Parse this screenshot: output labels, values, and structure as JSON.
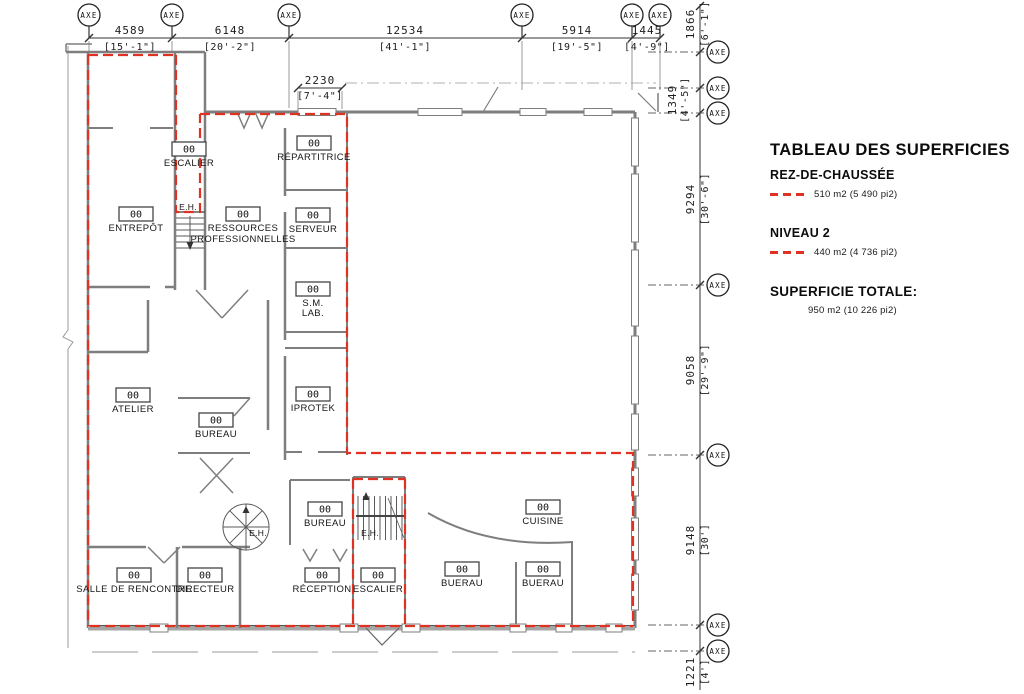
{
  "colors": {
    "overlay_red": "#DF3222",
    "wall_gray": "#8a8a8a",
    "line_dark": "#3c3c3c"
  },
  "axis_bubble_label": "AXE",
  "stair_exit_label": "E.H.",
  "dimensions": {
    "top": [
      {
        "mm": "4589",
        "imperial": "[15'-1\"]"
      },
      {
        "mm": "6148",
        "imperial": "[20'-2\"]"
      },
      {
        "mm": "12534",
        "imperial": "[41'-1\"]"
      },
      {
        "mm": "5914",
        "imperial": "[19'-5\"]"
      },
      {
        "mm": "1445",
        "imperial": "[4'-9\"]"
      }
    ],
    "top_right_vertical": {
      "mm": "1866",
      "imperial": "[6'-1\"]"
    },
    "interior": {
      "mm": "2230",
      "imperial": "[7'-4\"]"
    },
    "right": [
      {
        "mm": "1349",
        "imperial": "[4'-5\"]"
      },
      {
        "mm": "9294",
        "imperial": "[30'-6\"]"
      },
      {
        "mm": "9058",
        "imperial": "[29'-9\"]"
      },
      {
        "mm": "9148",
        "imperial": "[30']"
      },
      {
        "mm": "1221",
        "imperial": "[4']"
      }
    ]
  },
  "rooms": [
    {
      "number": "00",
      "label": "ESCALIER"
    },
    {
      "number": "00",
      "label": "ENTREPÔT"
    },
    {
      "number": "00",
      "label": "RESSOURCES",
      "label2": "PROFESSIONNELLES"
    },
    {
      "number": "00",
      "label": "RÉPARTITRICE"
    },
    {
      "number": "00",
      "label": "SERVEUR"
    },
    {
      "number": "00",
      "label": "S.M.",
      "label2": "LAB."
    },
    {
      "number": "00",
      "label": "ATELIER"
    },
    {
      "number": "00",
      "label": "BUREAU"
    },
    {
      "number": "00",
      "label": "IPROTEK"
    },
    {
      "number": "00",
      "label": "BUREAU"
    },
    {
      "number": "00",
      "label": "CUISINE"
    },
    {
      "number": "00",
      "label": "SALLE DE RENCONTRE"
    },
    {
      "number": "00",
      "label": "DIRECTEUR"
    },
    {
      "number": "00",
      "label": "RÉCEPTION"
    },
    {
      "number": "00",
      "label": "ESCALIER"
    },
    {
      "number": "00",
      "label": "BUERAU"
    },
    {
      "number": "00",
      "label": "BUERAU"
    }
  ],
  "legend": {
    "title": "TABLEAU DES SUPERFICIES",
    "entries": [
      {
        "name": "REZ-DE-CHAUSSÉE",
        "area": "510 m2 (5 490 pi2)"
      },
      {
        "name": "NIVEAU 2",
        "area": "440 m2 (4 736 pi2)"
      }
    ],
    "total_label": "SUPERFICIE TOTALE:",
    "total_area": "950 m2  (10 226 pi2)"
  }
}
